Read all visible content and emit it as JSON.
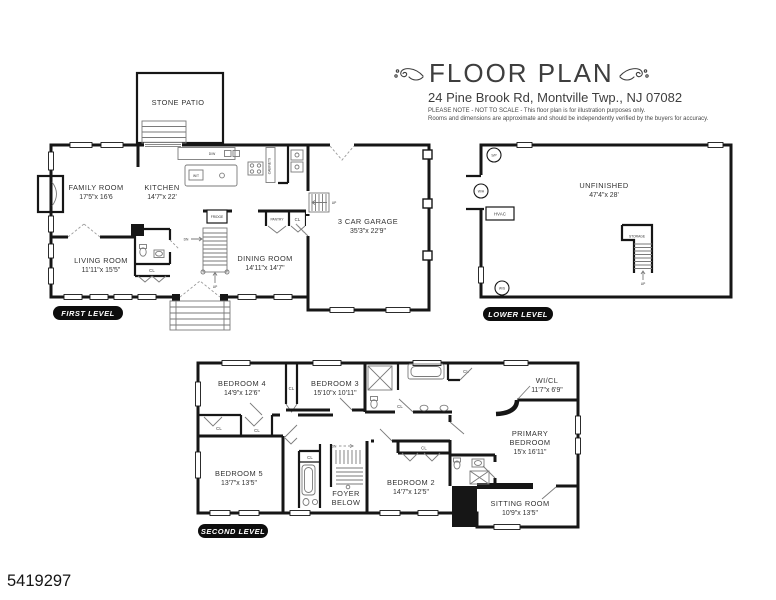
{
  "header": {
    "title": "FLOOR PLAN",
    "address": "24 Pine Brook Rd, Montville Twp., NJ 07082",
    "note1": "PLEASE NOTE - NOT TO SCALE - This floor plan is for illustration purposes only.",
    "note2": "Rooms and dimensions are approximate and should be independently verified by the buyers for accuracy."
  },
  "photo_id": "5419297",
  "first": {
    "badge": "FIRST LEVEL",
    "patio": "STONE PATIO",
    "family_name": "FAMILY ROOM",
    "family_dims": "17'5\"x 16'6",
    "kitchen_name": "KITCHEN",
    "kitchen_dims": "14'7\"x 22'",
    "living_name": "LIVING ROOM",
    "living_dims": "11'11\"x 15'5\"",
    "dining_name": "DINING ROOM",
    "dining_dims": "14'11\"x 14'7\"",
    "garage_name": "3 CAR GARAGE",
    "garage_dims": "35'3\"x 22'9\"",
    "dw": "D/W",
    "wt": "W/T",
    "cabinets": "CABINETS",
    "fridge": "FRIDGE",
    "pantry": "PANTRY",
    "cl": "CL",
    "dn": "DN",
    "up": "UP"
  },
  "lower": {
    "badge": "LOWER LEVEL",
    "unfinished_name": "UNFINISHED",
    "unfinished_dims": "47'4\"x 28'",
    "sp": "S/P",
    "wh": "W/H",
    "ws": "W/S",
    "hvac": "HVAC",
    "storage": "STORAGE",
    "up": "UP"
  },
  "second": {
    "badge": "SECOND LEVEL",
    "bedroom4_name": "BEDROOM 4",
    "bedroom4_dims": "14'9\"x 12'6\"",
    "bedroom3_name": "BEDROOM 3",
    "bedroom3_dims": "15'10\"x 10'11\"",
    "wicl_name": "WI/CL",
    "wicl_dims": "11'7\"x 6'9\"",
    "primary_name1": "PRIMARY",
    "primary_name2": "BEDROOM",
    "primary_dims": "15'x 16'11\"",
    "sitting_name": "SITTING ROOM",
    "sitting_dims": "10'9\"x 13'5\"",
    "bedroom2_name": "BEDROOM 2",
    "bedroom2_dims": "14'7\"x 12'5\"",
    "bedroom5_name": "BEDROOM 5",
    "bedroom5_dims": "13'7\"x 13'5\"",
    "foyer_name1": "FOYER",
    "foyer_name2": "BELOW",
    "cl": "CL",
    "dn": "DN"
  }
}
